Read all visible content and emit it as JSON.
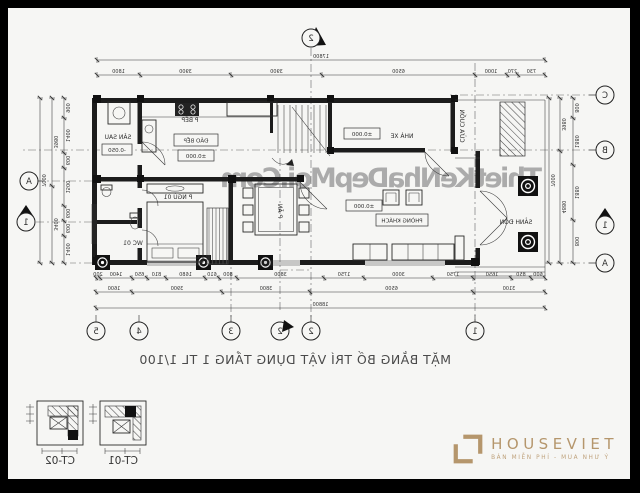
{
  "colors": {
    "frame": "#000000",
    "paper": "#f6f6f4",
    "ink": "#2a2a2a",
    "gold": "#b5966c",
    "watermark": "#8f8f8f"
  },
  "watermark": "ThietKeNhaDepMoi.Com",
  "title": "MẶT BẰNG BỐ TRÍ VẬT DỤNG TẦNG 1 TL 1/100",
  "logo": {
    "name": "HOUSEVIET",
    "tagline": "BÁN MIỄN PHÍ - MUA NHƯ Ý"
  },
  "rooms": {
    "san_sau": "SÂN SAU",
    "bep": "P BẾP",
    "dao_bep": "ĐẢO BẾP",
    "nha_xe": "NHÀ XE",
    "cua_cuon": "CỬA CUỐN",
    "p_an": "P ĂN",
    "p_ngu": "P NGỦ 01",
    "wc": "WC 01",
    "khach": "PHÒNG KHÁCH",
    "sanh_don": "SẢNH ĐÓN"
  },
  "levels": {
    "zero": "±0.000",
    "san_sau": "-0.050"
  },
  "axes": {
    "cols": [
      "1",
      "2",
      "2",
      "3",
      "4",
      "5"
    ],
    "left": [
      "C",
      "B",
      "A"
    ],
    "left_section": "1",
    "right_a": "A",
    "right_section": "1",
    "top_section": "2"
  },
  "dims": {
    "top_total": [
      "17800"
    ],
    "top": [
      "730",
      "270",
      "1000",
      "6500",
      "3900",
      "3900",
      "1800"
    ],
    "bottom_fine": [
      "600",
      "850",
      "1650",
      "1750",
      "3000",
      "1750",
      "3800",
      "800",
      "610",
      "1680",
      "810",
      "650",
      "1400",
      "200"
    ],
    "bottom_mid": [
      "3100",
      "6500",
      "3800",
      "3900",
      "1600"
    ],
    "bottom_total": [
      "18800"
    ],
    "left_inner": [
      "800",
      "1880",
      "1880",
      "800"
    ],
    "left_mid": [
      "3980",
      "4880"
    ],
    "left_total": [
      "7000"
    ],
    "right_inner": [
      "900",
      "1400",
      "600",
      "1500",
      "600",
      "600",
      "1400"
    ],
    "right_mid": [
      "3980",
      "3400"
    ],
    "right_total": [
      "7000"
    ]
  },
  "details": {
    "ct01": "CT-01",
    "ct02": "CT-02"
  }
}
